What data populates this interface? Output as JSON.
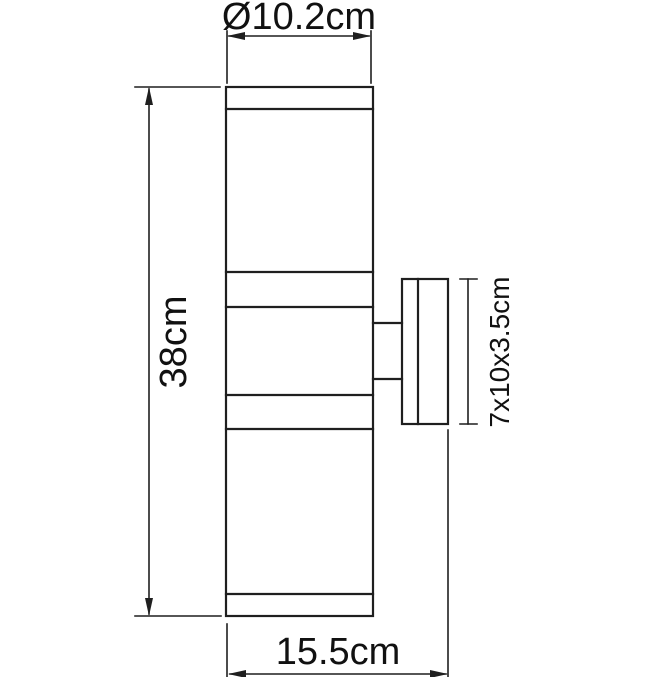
{
  "drawing": {
    "type": "technical-dimension-drawing",
    "subject": "cylindrical up-down wall lamp, side view with wall mount plate"
  },
  "colors": {
    "line": "#1f1f1f",
    "text": "#111111",
    "background": "#ffffff"
  },
  "dimensions": {
    "diameter": {
      "label": "Ø10.2cm",
      "value_cm": 10.2
    },
    "height": {
      "label": "38cm",
      "value_cm": 38
    },
    "mount_plate": {
      "label": "7x10x3.5cm",
      "value": "7x10x3.5"
    },
    "width_depth": {
      "label": "15.5cm",
      "value_cm": 15.5
    }
  }
}
